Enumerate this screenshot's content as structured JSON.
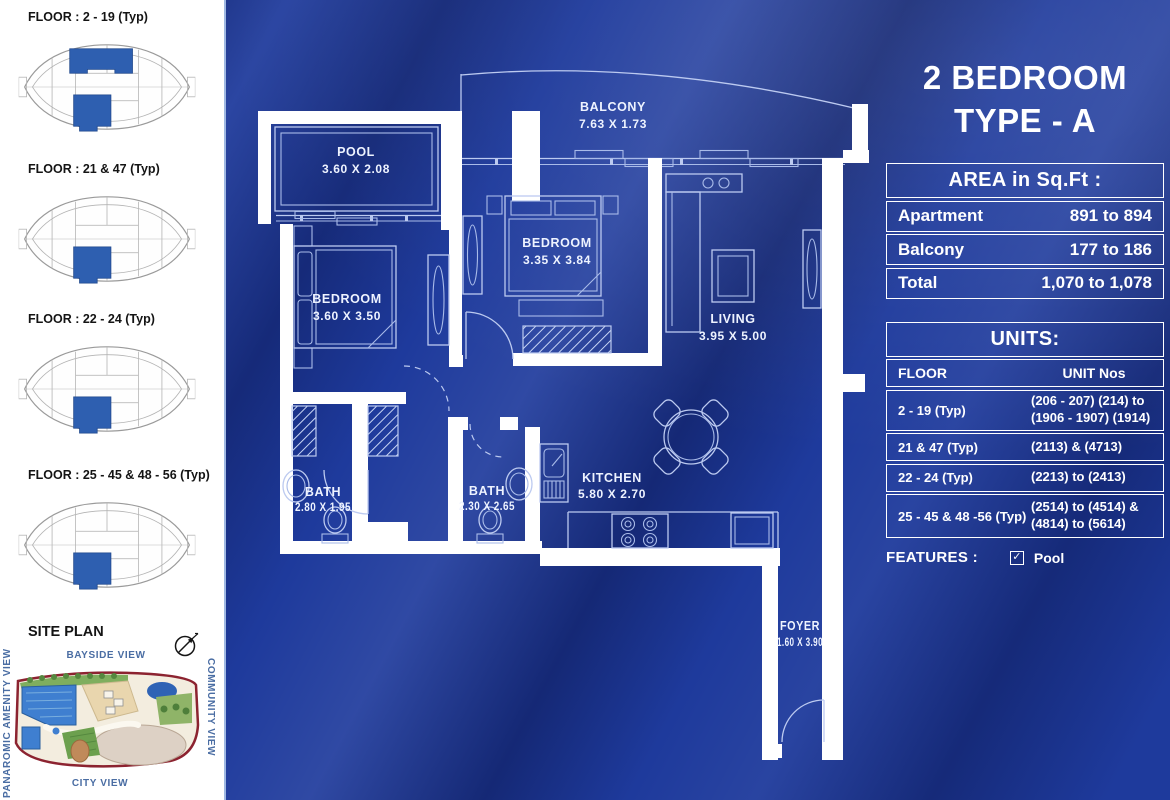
{
  "colors": {
    "brochure_blue": "#1e3a9c",
    "keyplan_highlight": "#2e5fb0",
    "wall_white": "#ffffff",
    "plan_line_blue": "#bccaf0",
    "view_label_blue": "#4a6da3"
  },
  "sidebar": {
    "key_plans": [
      {
        "label": "FLOOR : 2 - 19 (Typ)"
      },
      {
        "label": "FLOOR : 21 & 47 (Typ)"
      },
      {
        "label": "FLOOR : 22 - 24 (Typ)"
      },
      {
        "label": "FLOOR : 25 - 45 & 48 - 56 (Typ)"
      }
    ],
    "site_plan": {
      "title": "SITE PLAN",
      "view_top": "BAYSIDE VIEW",
      "view_right": "COMMUNITY VIEW",
      "view_bottom": "CITY VIEW",
      "view_left": "PANAROMIC AMENITY VIEW"
    }
  },
  "plan": {
    "rooms": {
      "pool": {
        "name": "POOL",
        "dims": "3.60 X 2.08"
      },
      "balcony": {
        "name": "BALCONY",
        "dims": "7.63 X 1.73"
      },
      "bedroom1": {
        "name": "BEDROOM",
        "dims": "3.60 X 3.50"
      },
      "bedroom2": {
        "name": "BEDROOM",
        "dims": "3.35 X 3.84"
      },
      "living": {
        "name": "LIVING",
        "dims": "3.95 X 5.00"
      },
      "bath1": {
        "name": "BATH",
        "dims": "2.80 X 1.95"
      },
      "bath2": {
        "name": "BATH",
        "dims": "2.30 X 2.65"
      },
      "kitchen": {
        "name": "KITCHEN",
        "dims": "5.80 X 2.70"
      },
      "foyer": {
        "name": "FOYER",
        "dims": "1.60 X 3.90"
      }
    }
  },
  "panel": {
    "title_line1": "2 BEDROOM",
    "title_line2": "TYPE - A",
    "area_table": {
      "header": "AREA in Sq.Ft :",
      "rows": [
        {
          "label": "Apartment",
          "value": "891 to 894"
        },
        {
          "label": "Balcony",
          "value": "177 to 186"
        },
        {
          "label": "Total",
          "value": "1,070 to 1,078"
        }
      ]
    },
    "units_table": {
      "header": "UNITS:",
      "col1": "FLOOR",
      "col2": "UNIT Nos",
      "rows": [
        {
          "floor": "2 - 19 (Typ)",
          "units": "(206 - 207) (214) to (1906 - 1907) (1914)"
        },
        {
          "floor": "21 & 47 (Typ)",
          "units": "(2113) & (4713)"
        },
        {
          "floor": "22 - 24 (Typ)",
          "units": "(2213) to (2413)"
        },
        {
          "floor": "25 - 45 & 48 -56 (Typ)",
          "units": "(2514) to (4514) & (4814) to (5614)"
        }
      ]
    },
    "features": {
      "label": "FEATURES :",
      "item": "Pool"
    }
  }
}
